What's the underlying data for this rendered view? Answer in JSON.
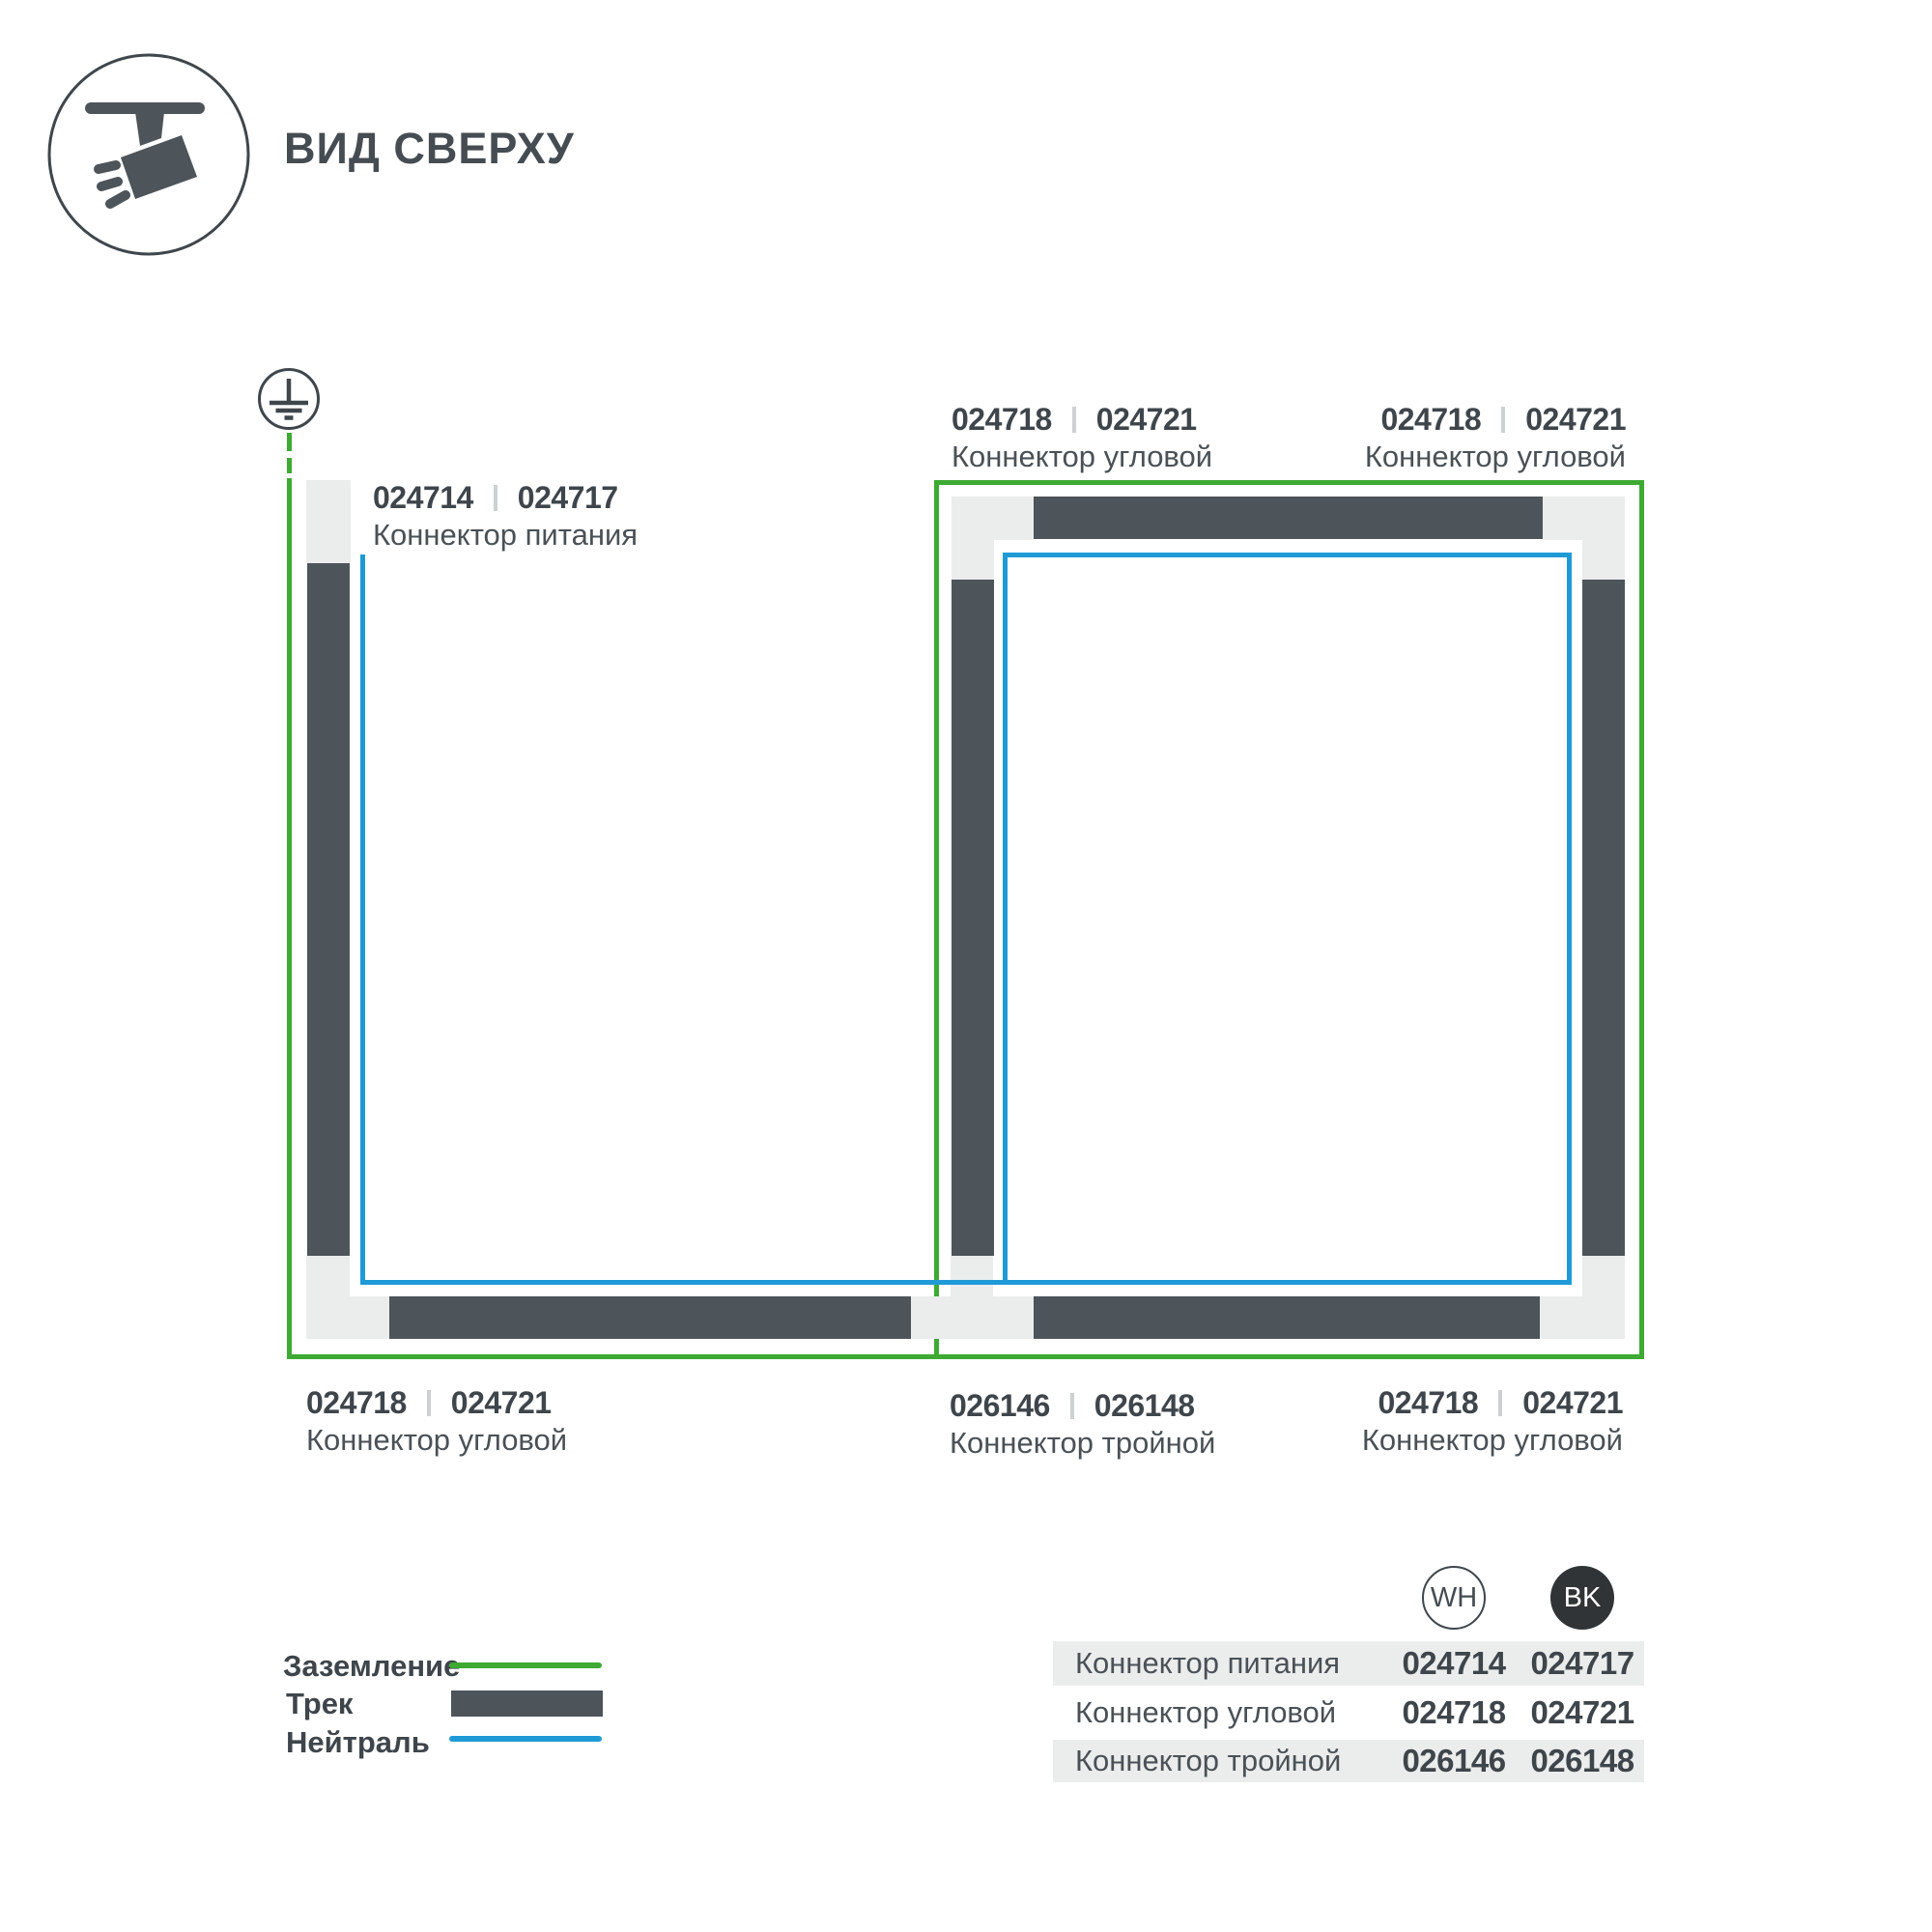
{
  "title": "ВИД СВЕРХУ",
  "diagram": {
    "labels": {
      "power": {
        "code_wh": "024714",
        "code_bk": "024717",
        "name": "Коннектор питания"
      },
      "corner_top_mid": {
        "code_wh": "024718",
        "code_bk": "024721",
        "name": "Коннектор угловой"
      },
      "corner_top_right": {
        "code_wh": "024718",
        "code_bk": "024721",
        "name": "Коннектор угловой"
      },
      "corner_bottom_left": {
        "code_wh": "024718",
        "code_bk": "024721",
        "name": "Коннектор угловой"
      },
      "triple_bottom_mid": {
        "code_wh": "026146",
        "code_bk": "026148",
        "name": "Коннектор тройной"
      },
      "corner_bottom_right": {
        "code_wh": "024718",
        "code_bk": "024721",
        "name": "Коннектор угловой"
      }
    }
  },
  "legend": {
    "ground": "Заземление",
    "track": "Трек",
    "neutral": "Нейтраль"
  },
  "table": {
    "col_wh": "WH",
    "col_bk": "BK",
    "rows": [
      {
        "name": "Коннектор питания",
        "wh": "024714",
        "bk": "024717"
      },
      {
        "name": "Коннектор угловой",
        "wh": "024718",
        "bk": "024721"
      },
      {
        "name": "Коннектор тройной",
        "wh": "026146",
        "bk": "026148"
      }
    ]
  },
  "colors": {
    "ground_green": "#3eaa34",
    "neutral_blue": "#1f9ad6",
    "track_dark": "#4d545a",
    "connector_gray": "#ebecec",
    "text_dark": "#3e454b",
    "text_regular": "#4a5156",
    "divider_gray": "#ccd0d1",
    "row_bg": "#ebecec",
    "bk_badge": "#303437"
  }
}
